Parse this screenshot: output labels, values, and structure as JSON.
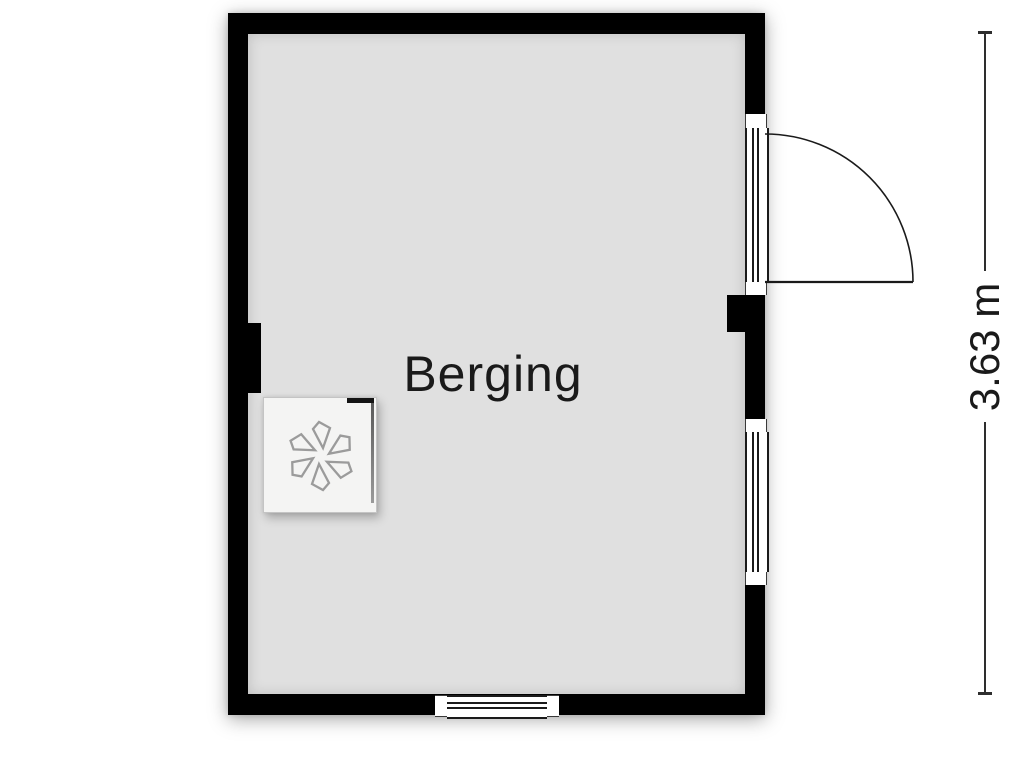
{
  "plan": {
    "type": "floorplan",
    "room": {
      "label": "Berging"
    },
    "dimension": {
      "label": "3.63 m",
      "side": "right"
    },
    "features": {
      "door": {
        "wall": "right",
        "swing": "outward-right"
      },
      "windows": [
        {
          "wall": "right"
        },
        {
          "wall": "bottom"
        }
      ],
      "wall_piers": [
        {
          "wall": "left"
        },
        {
          "wall": "right"
        }
      ]
    },
    "fixtures": [
      {
        "name": "ventilation-unit",
        "icon": "fan-icon"
      }
    ],
    "colors": {
      "wall": "#000000",
      "floor": "#e0e0e0",
      "line": "#1a1a1a",
      "fixture_fill": "#f4f4f3",
      "fan_stroke": "#9b9b9b"
    }
  }
}
